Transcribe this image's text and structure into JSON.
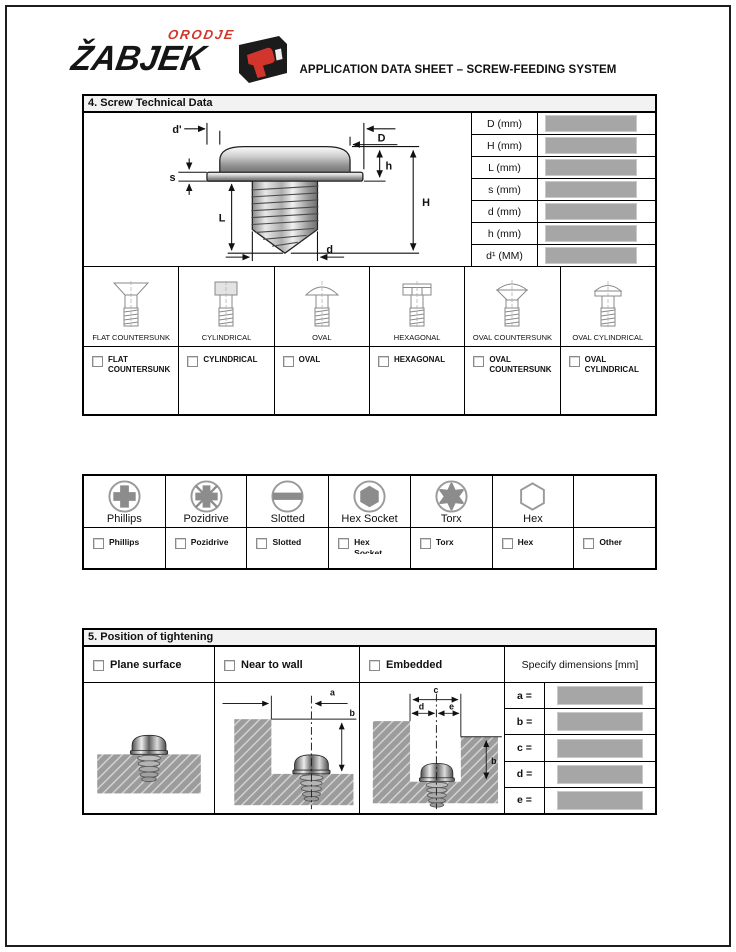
{
  "header": {
    "logo_main": "ŽABJEK",
    "logo_sub": "ORODJE",
    "title": "APPLICATION DATA SHEET – SCREW-FEEDING SYSTEM"
  },
  "colors": {
    "accent_red": "#d2352b",
    "input_gray": "#a6a6a6",
    "section_header_bg": "#f2f2f2",
    "border_black": "#000000"
  },
  "section4": {
    "title": "4. Screw Technical Data",
    "diagram_labels": {
      "d_prime": "d'",
      "big_d": "D",
      "h": "h",
      "s": "s",
      "l": "L",
      "big_h": "H",
      "d": "d"
    },
    "dimensions": [
      {
        "label": "D (mm)",
        "value": ""
      },
      {
        "label": "H (mm)",
        "value": ""
      },
      {
        "label": "L (mm)",
        "value": ""
      },
      {
        "label": "s (mm)",
        "value": ""
      },
      {
        "label": "d (mm)",
        "value": ""
      },
      {
        "label": "h (mm)",
        "value": ""
      },
      {
        "label": "d¹ (MM)",
        "value": ""
      }
    ],
    "head_types": [
      {
        "label": "FLAT COUNTERSUNK",
        "checkbox": "FLAT COUNTERSUNK",
        "checked": false
      },
      {
        "label": "CYLINDRICAL",
        "checkbox": "CYLINDRICAL",
        "checked": false
      },
      {
        "label": "OVAL",
        "checkbox": "OVAL",
        "checked": false
      },
      {
        "label": "HEXAGONAL",
        "checkbox": "HEXAGONAL",
        "checked": false
      },
      {
        "label": "OVAL COUNTERSUNK",
        "checkbox": "OVAL COUNTERSUNK",
        "checked": false
      },
      {
        "label": "OVAL CYLINDRICAL",
        "checkbox": "OVAL CYLINDRICAL",
        "checked": false
      }
    ]
  },
  "drive": {
    "options": [
      {
        "label": "Phillips"
      },
      {
        "label": "Pozidrive"
      },
      {
        "label": "Slotted"
      },
      {
        "label": "Hex Socket"
      },
      {
        "label": "Torx"
      },
      {
        "label": "Hex"
      }
    ],
    "checkboxes": [
      {
        "label": "Phillips",
        "checked": false
      },
      {
        "label": "Pozidrive",
        "checked": false
      },
      {
        "label": "Slotted",
        "checked": false
      },
      {
        "label": "Hex Socket",
        "checked": false
      },
      {
        "label": "Torx",
        "checked": false
      },
      {
        "label": "Hex",
        "checked": false
      },
      {
        "label": "Other",
        "checked": false
      }
    ]
  },
  "section5": {
    "title": "5. Position of tightening",
    "options": [
      {
        "label": "Plane surface",
        "checked": false
      },
      {
        "label": "Near to wall",
        "checked": false
      },
      {
        "label": "Embedded",
        "checked": false
      }
    ],
    "specify_label": "Specify dimensions [mm]",
    "diagram_labels": {
      "a": "a",
      "b": "b",
      "c": "c",
      "d": "d",
      "e": "e",
      "b2": "b"
    },
    "dim_rows": [
      {
        "label": "a =",
        "value": ""
      },
      {
        "label": "b =",
        "value": ""
      },
      {
        "label": "c =",
        "value": ""
      },
      {
        "label": "d =",
        "value": ""
      },
      {
        "label": "e =",
        "value": ""
      }
    ]
  }
}
